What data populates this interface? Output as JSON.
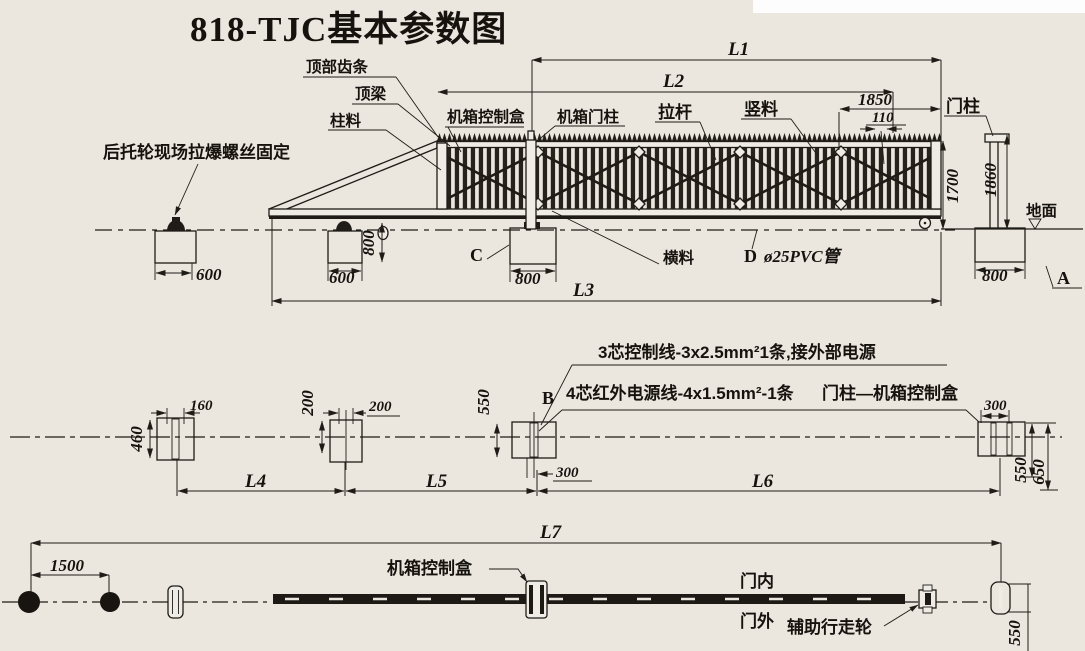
{
  "title": "818-TJC基本参数图",
  "top_view": {
    "labels": {
      "top_rack": "顶部齿条",
      "top_beam": "顶梁",
      "column_stock": "柱料",
      "control_box": "机箱控制盒",
      "machine_post": "机箱门柱",
      "pull_rod": "拉杆",
      "vertical_stock": "竖料",
      "door_post": "门柱",
      "ground": "地面",
      "rear_wheel_note": "后托轮现场拉爆螺丝固定",
      "cross_rail": "横料",
      "pvc_pipe": "ø25PVC管"
    },
    "markers": {
      "a": "A",
      "c": "C",
      "d": "D"
    },
    "dims": {
      "l1": "L1",
      "l2": "L2",
      "l3": "L3",
      "d1850": "1850",
      "d110": "110",
      "d1700": "1700",
      "d1860": "1860",
      "d600_left": "600",
      "d600_mid": "600",
      "d800_depth": "800",
      "d800_c": "800",
      "d800_right": "800"
    }
  },
  "middle_view": {
    "markers": {
      "b": "B"
    },
    "notes": {
      "control_line": "3芯控制线-3x2.5mm²1条,接外部电源",
      "infrared_line": "4芯红外电源线-4x1.5mm²-1条",
      "post_to_box": "门柱—机箱控制盒"
    },
    "dims": {
      "d460": "460",
      "d160": "160",
      "d200_v": "200",
      "d200_h": "200",
      "d550": "550",
      "d300_mid": "300",
      "d300_right": "300",
      "d550_right": "550",
      "d650": "650",
      "l4": "L4",
      "l5": "L5",
      "l6": "L6"
    }
  },
  "bottom_view": {
    "labels": {
      "control_box": "机箱控制盒",
      "door_inside": "门内",
      "door_outside": "门外",
      "aux_wheel": "辅助行走轮"
    },
    "dims": {
      "l7": "L7",
      "d1500": "1500",
      "d550": "550"
    }
  }
}
